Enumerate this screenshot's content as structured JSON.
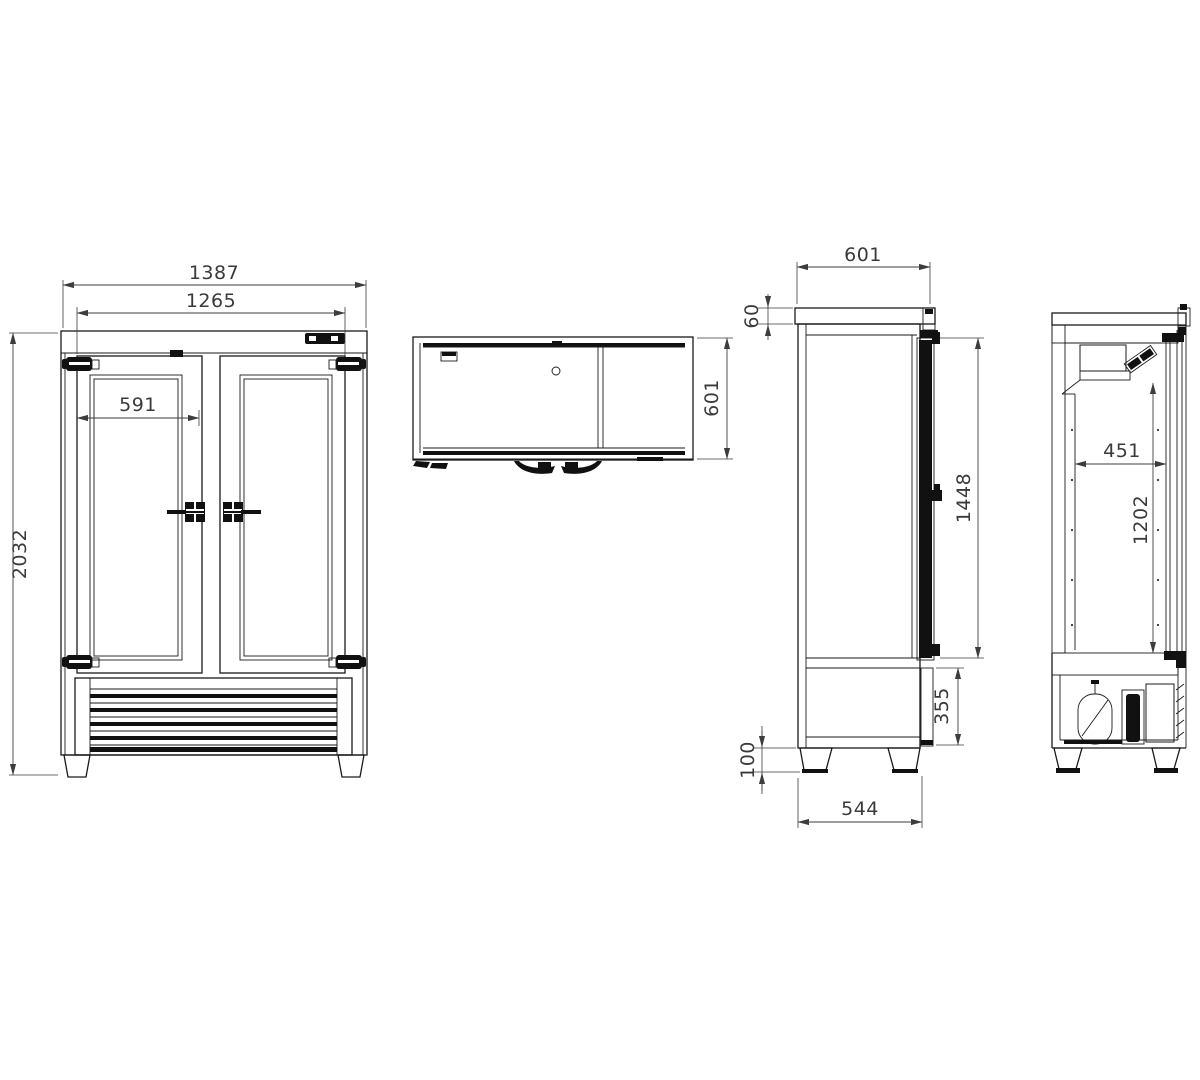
{
  "meta": {
    "background_color": "#ffffff",
    "line_color": "#1a1a1a",
    "dimension_color": "#3d3d3d"
  },
  "views": {
    "front": {
      "dims": {
        "overall_width": "1387",
        "doors_outer_width": "1265",
        "door_leaf_width": "591",
        "overall_height": "2032"
      }
    },
    "top": {
      "dims": {
        "depth": "601"
      }
    },
    "side": {
      "dims": {
        "depth": "601",
        "top_panel_height": "60",
        "door_height": "1448",
        "machine_panel_height": "355",
        "leg_height": "100",
        "feet_depth": "544"
      }
    },
    "section": {
      "dims": {
        "interior_depth": "451",
        "interior_height": "1202"
      }
    }
  }
}
